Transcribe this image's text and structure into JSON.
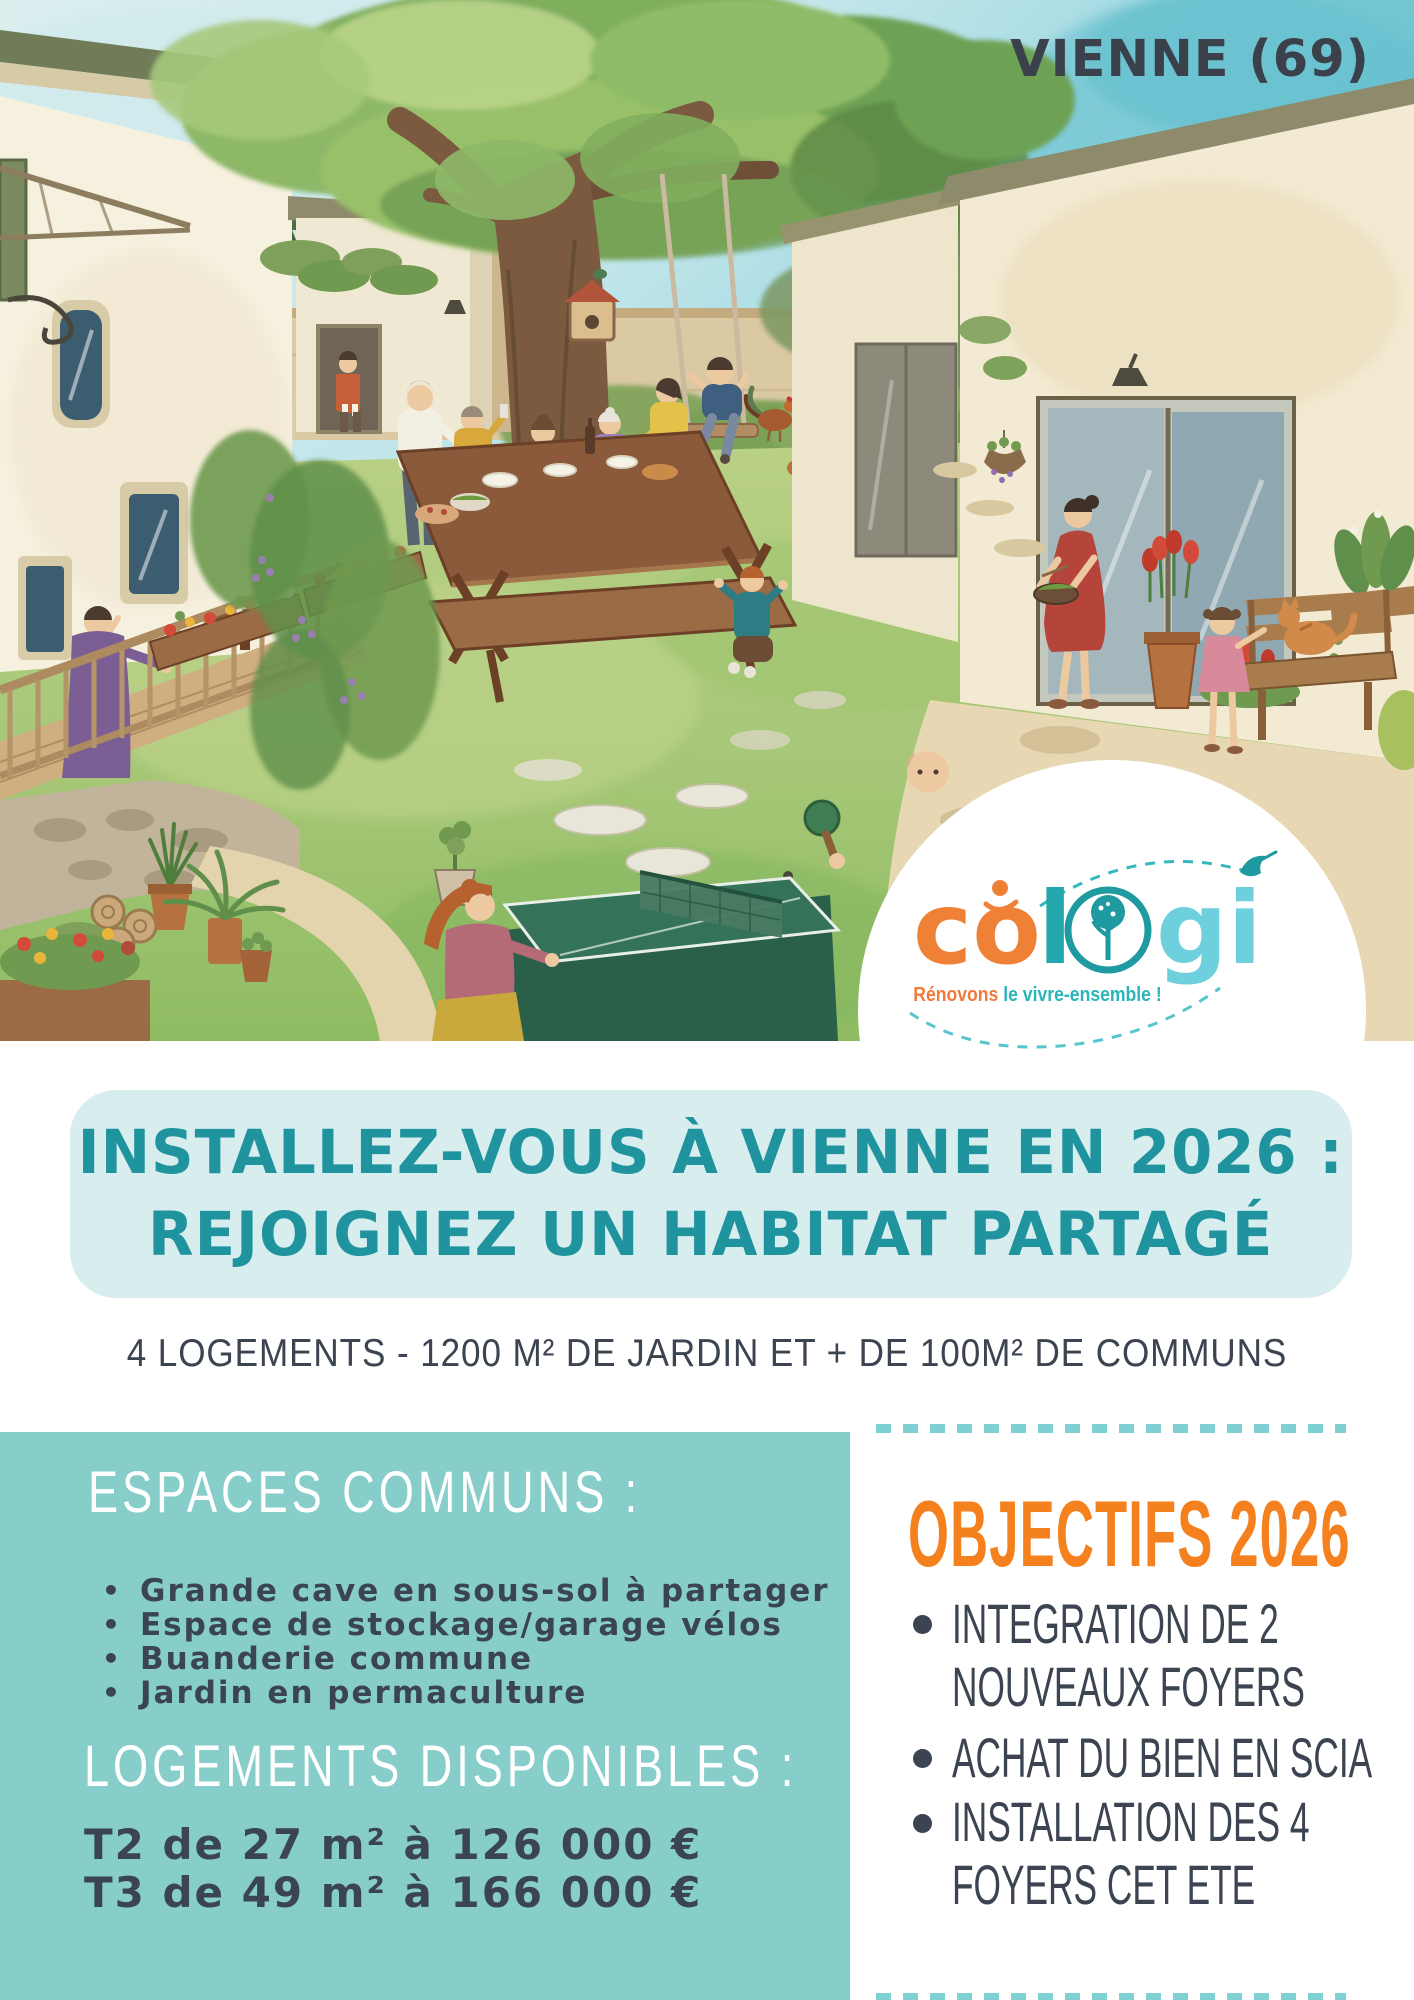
{
  "poster": {
    "location_label": "VIENNE (69)"
  },
  "logo": {
    "word": "cologi",
    "part_co": "co",
    "part_l": "l",
    "part_gi": "gi",
    "tagline_orange": "Rénovons",
    "tagline_teal": " le vivre-ensemble !"
  },
  "hero": {
    "title_line1": "INSTALLEZ-VOUS À VIENNE EN 2026 :",
    "title_line2": "REJOIGNEZ UN HABITAT PARTAGÉ",
    "subtitle": "4 LOGEMENTS - 1200 M² DE JARDIN ET + DE 100M² DE COMMUNS"
  },
  "left_panel": {
    "heading_spaces": "ESPACES COMMUNS :",
    "bullets": [
      "Grande cave en sous-sol à partager",
      "Espace de stockage/garage vélos",
      "Buanderie commune",
      "Jardin en permaculture"
    ],
    "heading_homes": "LOGEMENTS DISPONIBLES :",
    "offers": [
      "T2 de 27 m² à 126 000 €",
      "T3 de 49 m² à 166 000 €"
    ]
  },
  "right_panel": {
    "heading": "OBJECTIFS 2026",
    "bullets": [
      {
        "line1": "INTEGRATION DE 2",
        "line2": "NOUVEAUX FOYERS"
      },
      {
        "line1": "ACHAT DU BIEN EN SCIA",
        "line2": ""
      },
      {
        "line1": "INSTALLATION DES 4",
        "line2": "FOYERS CET ETE"
      }
    ]
  },
  "colors": {
    "headline_teal": "#1f939e",
    "panel_teal": "#87cecb",
    "box_light_blue": "#d8edee",
    "accent_orange": "#f5801e",
    "text_dark": "#3b4450",
    "dash_teal": "#7ed0d3",
    "logo_orange": "#ef8136",
    "logo_teal": "#25a8ad",
    "logo_cyan": "#6fd0dd"
  },
  "illustration": {
    "description": "Watercolor illustration of a shared garden courtyard: two houses, a large tree with a swing, neighbors sharing a meal at a picnic table, a ping-pong table, hens, a child's tent, flower beds, and a bench with a little girl and a cat."
  }
}
